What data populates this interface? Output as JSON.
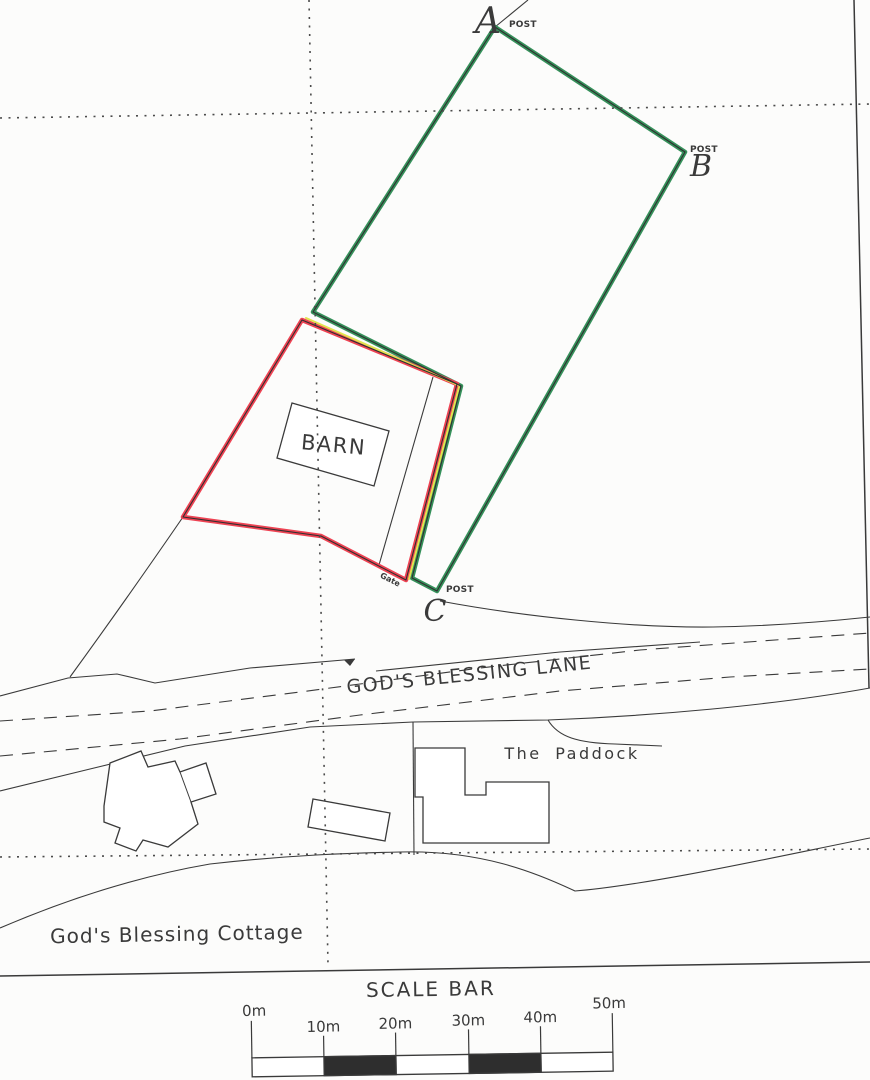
{
  "plan": {
    "points": {
      "a": {
        "letter": "A",
        "post_label": "POST"
      },
      "b": {
        "letter": "B",
        "post_label": "POST"
      },
      "c": {
        "letter": "C",
        "post_label": "POST"
      }
    },
    "features": {
      "barn": "BARN",
      "gate": "Gate",
      "lane": "GOD'S BLESSING LANE",
      "paddock": "The Paddock",
      "cottage": "God's Blessing Cottage"
    },
    "scale_bar": {
      "title": "SCALE BAR",
      "ticks": [
        "0m",
        "10m",
        "20m",
        "30m",
        "40m",
        "50m"
      ]
    },
    "colors": {
      "field_boundary_green": "#35905a",
      "plot_boundary_red": "#ee4353",
      "boundary_highlight_yellow": "#e2e34f",
      "ink": "#3a3a3a",
      "gate_red": "#d03030",
      "scale_fill_dark": "#2e2e2e"
    }
  }
}
